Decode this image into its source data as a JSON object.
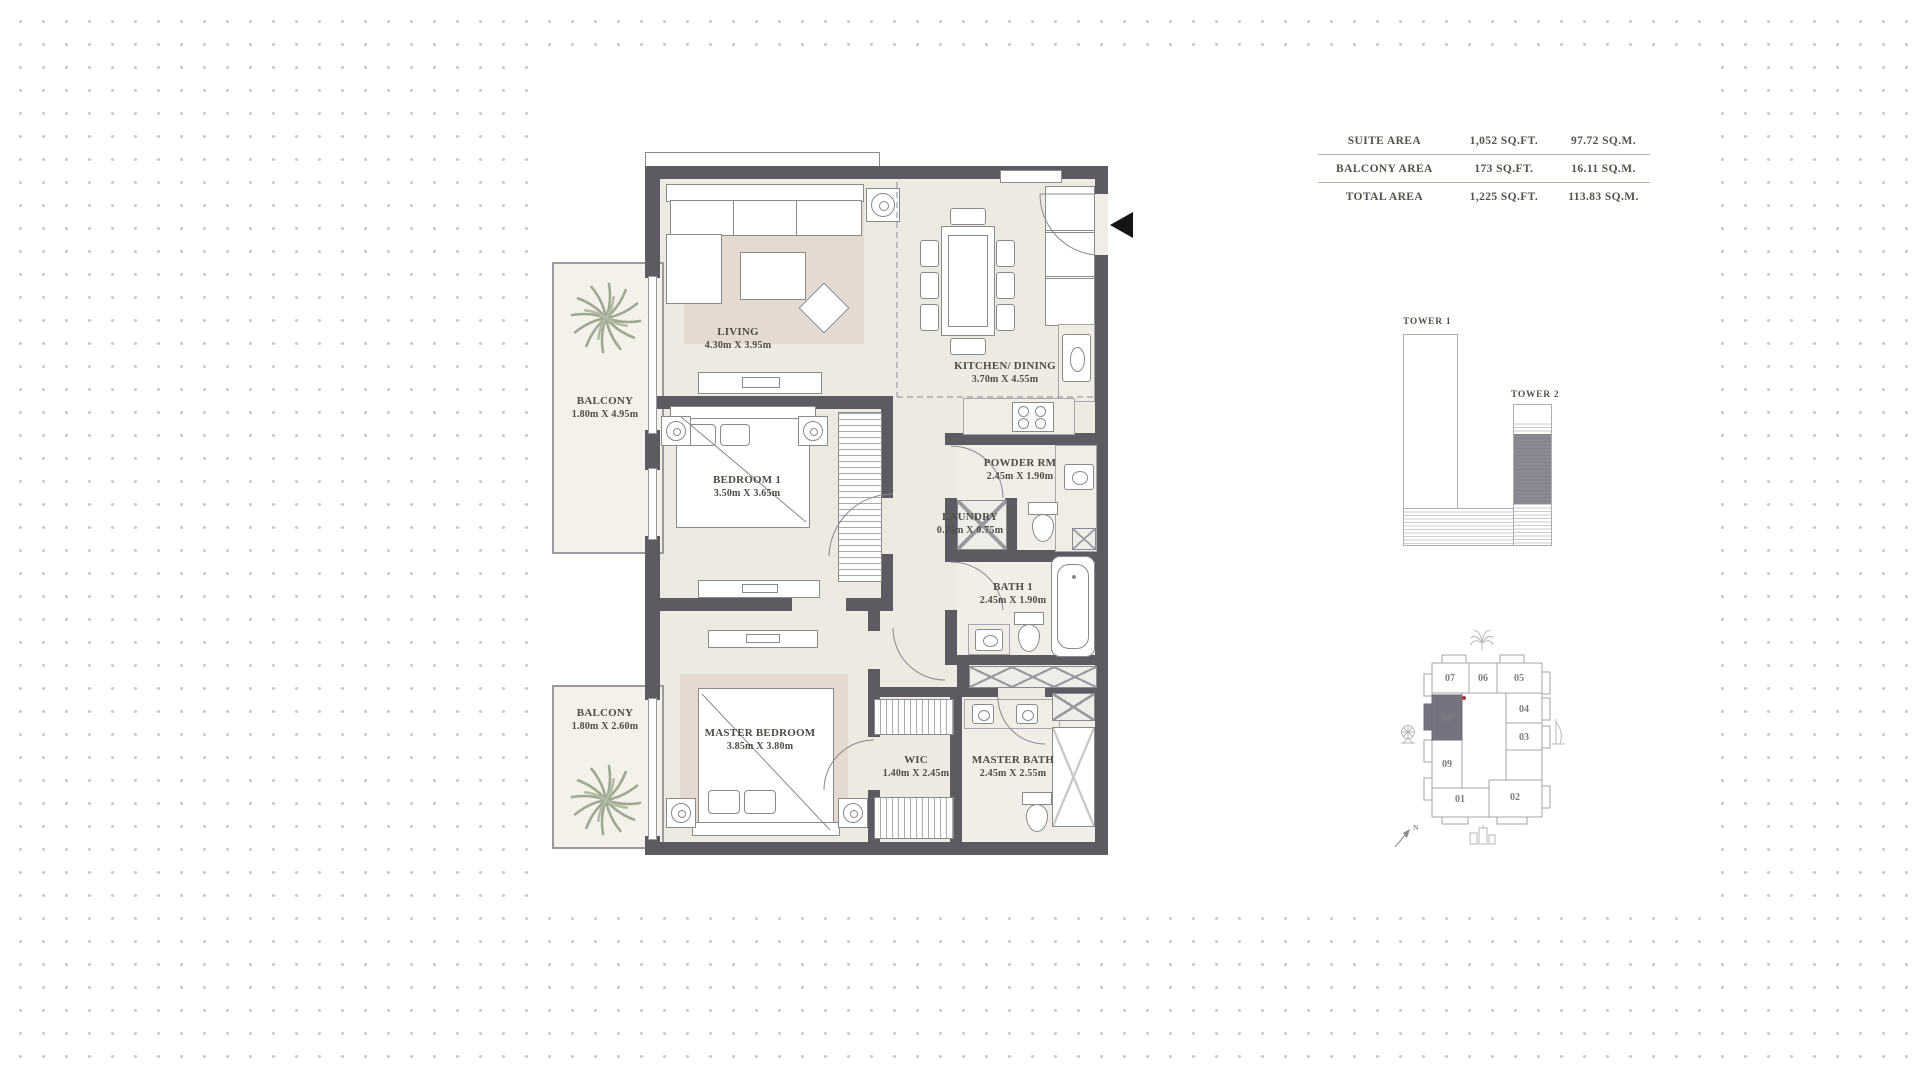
{
  "plan": {
    "rooms": [
      {
        "name": "LIVING",
        "dims": "4.30m X 3.95m"
      },
      {
        "name": "KITCHEN/ DINING",
        "dims": "3.70m X 4.55m"
      },
      {
        "name": "BALCONY",
        "dims": "1.80m X 4.95m"
      },
      {
        "name": "BEDROOM 1",
        "dims": "3.50m X 3.65m"
      },
      {
        "name": "POWDER RM",
        "dims": "2.45m X 1.90m"
      },
      {
        "name": "LAUNDRY",
        "dims": "0.75m X 0.75m"
      },
      {
        "name": "BATH 1",
        "dims": "2.45m X 1.90m"
      },
      {
        "name": "MASTER BEDROOM",
        "dims": "3.85m X 3.80m"
      },
      {
        "name": "WIC",
        "dims": "1.40m X 2.45m"
      },
      {
        "name": "MASTER BATH",
        "dims": "2.45m X 2.55m"
      },
      {
        "name": "BALCONY",
        "dims": "1.80m X 2.60m"
      }
    ]
  },
  "areas": {
    "rows": [
      {
        "label": "SUITE AREA",
        "sqft": "1,052 SQ.FT.",
        "sqm": "97.72 SQ.M."
      },
      {
        "label": "BALCONY AREA",
        "sqft": "173 SQ.FT.",
        "sqm": "16.11 SQ.M."
      },
      {
        "label": "TOTAL AREA",
        "sqft": "1,225 SQ.FT.",
        "sqm": "113.83 SQ.M."
      }
    ]
  },
  "towers": {
    "t1_label": "TOWER 1",
    "t2_label": "TOWER 2"
  },
  "keyplan": {
    "highlighted_unit": "08",
    "north_label": "N",
    "units": [
      {
        "label": "07"
      },
      {
        "label": "06"
      },
      {
        "label": "05"
      },
      {
        "label": "08"
      },
      {
        "label": "04"
      },
      {
        "label": "03"
      },
      {
        "label": "09"
      },
      {
        "label": "01"
      },
      {
        "label": "02"
      }
    ]
  },
  "colors": {
    "wall": "#5e5a62",
    "floor": "#edeae1",
    "rug": "#e4dacf",
    "highlight": "#767380",
    "marker_red": "#b2392e",
    "dots": "#c8c8c8"
  }
}
